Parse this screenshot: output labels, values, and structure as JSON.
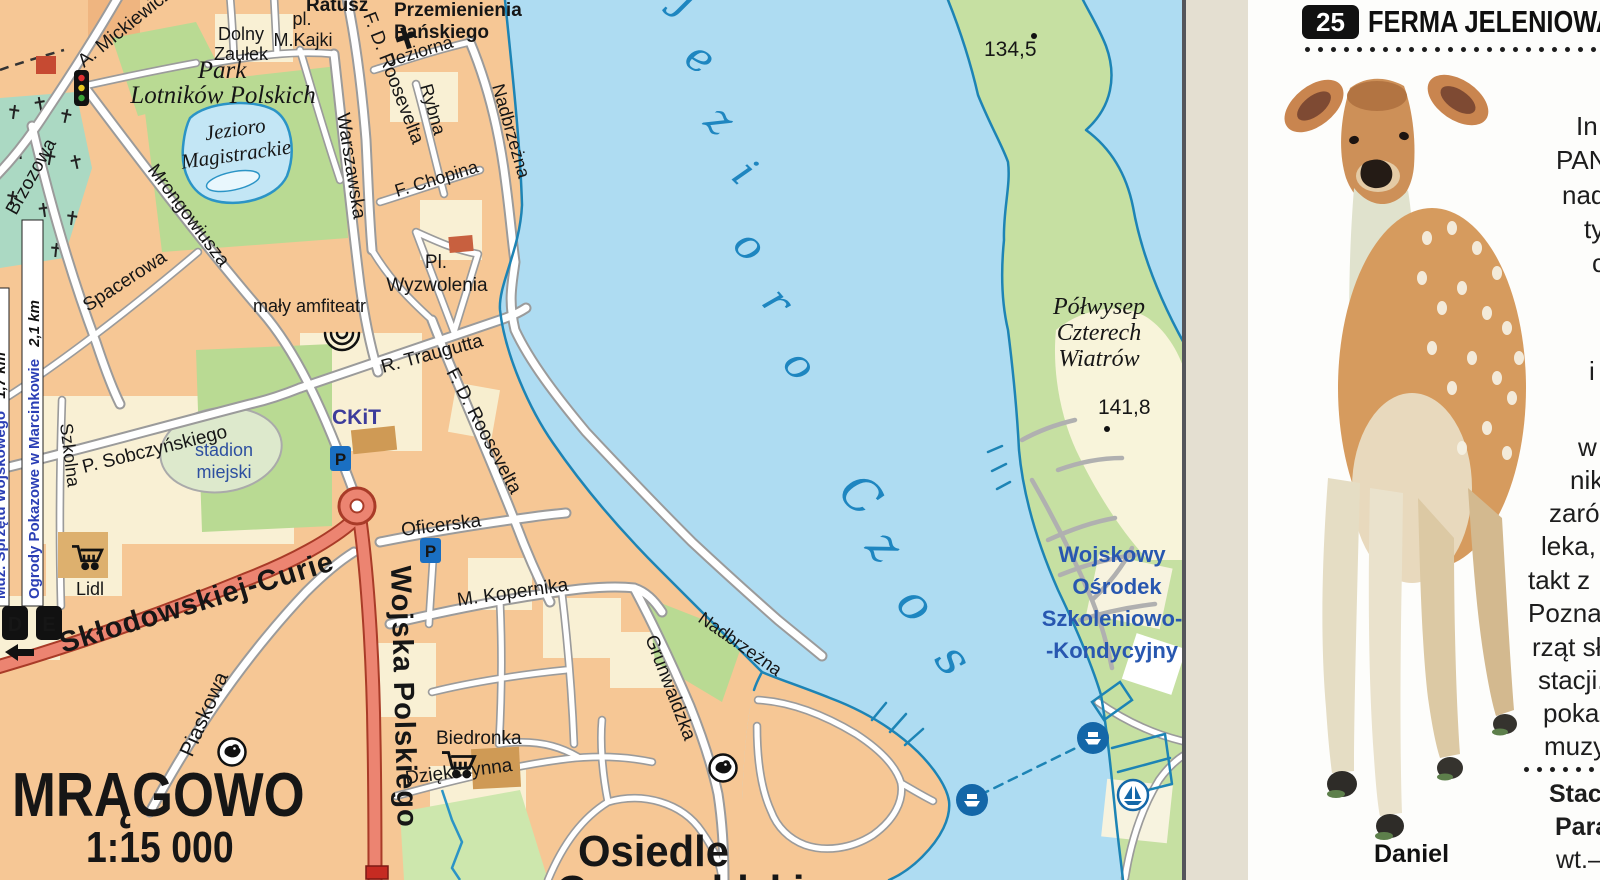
{
  "map": {
    "title": "MRĄGOWO",
    "scale": "1:15 000",
    "lake_letters": [
      "J",
      "e",
      "z",
      "i",
      "o",
      "r",
      "o",
      "C",
      "z",
      "o",
      "s"
    ],
    "streets": {
      "mickiewicza": "A. Mickiewicza",
      "brzozowa": "Brzozowa",
      "mrongowiusza": "Mrongowiusza",
      "spacerowa": "Spacerowa",
      "szkolna": "Szkolna",
      "sobczynskiego": "P. Sobczyńskiego",
      "traugutta": "R. Traugutta",
      "roosevelta_n": "F. D. Roosevelta",
      "roosevelta_s": "F. D. Roosevelta",
      "warszawska": "Warszawska",
      "jeziorna": "Jeziorna",
      "rybna": "Rybna",
      "chopina": "F. Chopina",
      "nadbrzezna_n": "Nadbrzeżna",
      "nadbrzezna_s": "Nadbrzeżna",
      "oficerska": "Oficerska",
      "kopernika": "M. Kopernika",
      "piaskowa": "Piaskowa",
      "dziekczynna": "Dziękczynna",
      "grunwaldzka": "Grunwaldzka",
      "wojska_polskiego": "Wojska Polskiego",
      "sklodowskiej_curie": "Skłodowskiej-Curie",
      "dolny_1": "Dolny",
      "dolny_2": "Zaułek",
      "kajki_1": "pl.",
      "kajki_2": "M.Kajki",
      "wyzwolenia_1": "Pl.",
      "wyzwolenia_2": "Wyzwolenia"
    },
    "places": {
      "ratusz": "Ratusz",
      "church_1": "Przemienienia",
      "church_2": "Pańskiego",
      "park_1": "Park",
      "park_2": "Lotników Polskich",
      "magistrackie_1": "Jezioro",
      "magistrackie_2": "Magistrackie",
      "amfiteatr": "mały amfiteatr",
      "ckit": "CKiT",
      "stadion_1": "stadion",
      "stadion_2": "miejski",
      "lidl": "Lidl",
      "biedronka": "Biedronka",
      "polwysep_1": "Półwysep",
      "polwysep_2": "Czterech",
      "polwysep_3": "Wiatrów",
      "wojskowy_1": "Wojskowy",
      "wojskowy_2": "Ośrodek",
      "wojskowy_3": "Szkoleniowo-",
      "wojskowy_4": "-Kondycyjny",
      "osiedle_1": "Osiedle",
      "osiedle_2": "Grunwaldzkie",
      "spot_134": "134,5",
      "spot_141": "141,8"
    },
    "routes": {
      "d_text": "Muz. Sprzętu Wojskowego",
      "d_dist": "1,7 km",
      "d_badge": "D",
      "e_text": "Ogrody Pokazowe w Marcinkowie",
      "e_dist": "2,1 km",
      "e_badge": "E"
    },
    "icons": {
      "parking": "P"
    }
  },
  "guide": {
    "number": "25",
    "title": "FERMA JELENIOWA",
    "lines": [
      "In",
      "PAN",
      "nad",
      "ty",
      "c",
      "i",
      "w",
      "nik",
      "zaró",
      "leka,",
      "takt z",
      "Pozna",
      "rząt sł",
      "stacji.",
      "pokaz",
      "muzy"
    ],
    "info_1": "Stacja",
    "info_2": "Paraz",
    "hours": "wt.–n",
    "caption": "Daniel"
  },
  "colors": {
    "water": "#aedcf2",
    "land": "#f6c795",
    "green": "#b9da93",
    "peninsula": "#c6e0a2",
    "cemetery": "#abd9c3",
    "main_road": "#ec8471",
    "shoreline": "#1d84b5",
    "lake_label": "#1e86c0",
    "poi_label": "#3c3c9b",
    "info_label": "#2857b0",
    "district_pink": "#ef5f94",
    "cream_block": "#f9f0d4"
  }
}
